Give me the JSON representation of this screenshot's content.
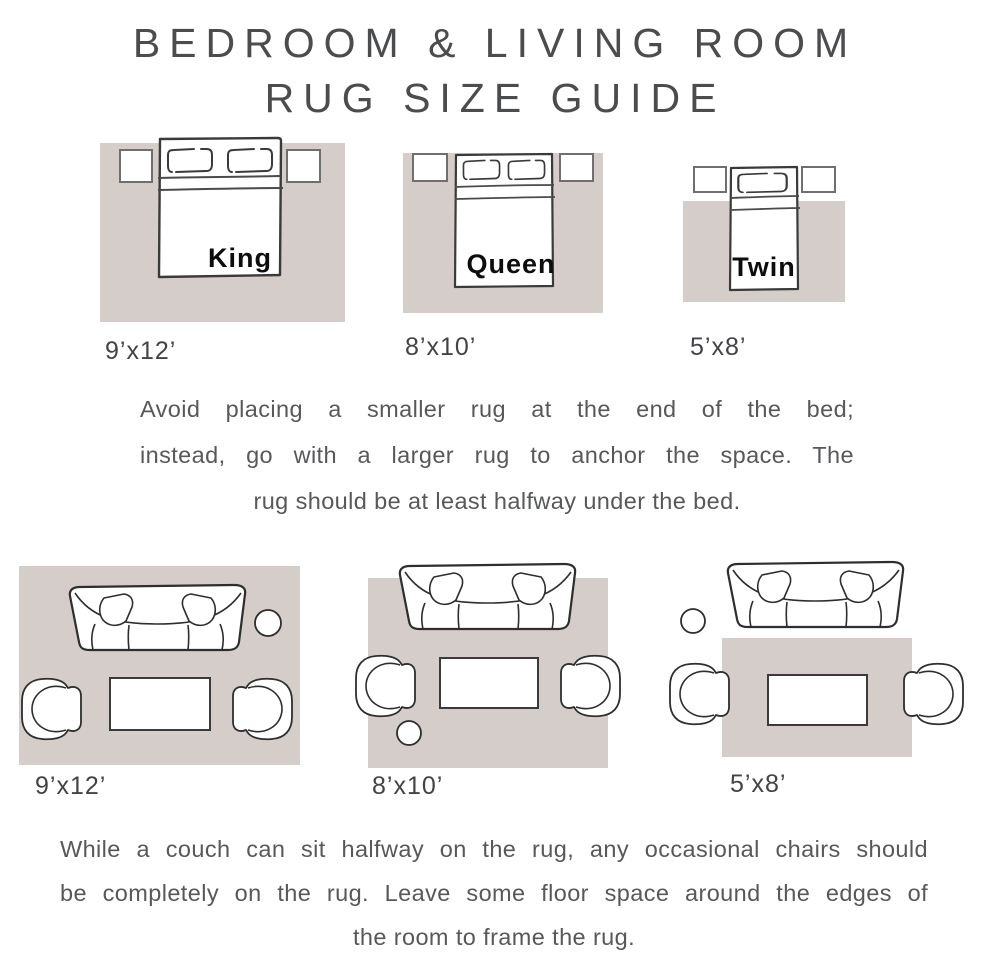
{
  "title": {
    "line1": "BEDROOM & LIVING ROOM",
    "line2": "RUG SIZE GUIDE"
  },
  "bedroom": {
    "diagrams": [
      {
        "bed": "King",
        "size": "9’x12’",
        "rug": "9 x 12 rug with king bed and two nightstands"
      },
      {
        "bed": "Queen",
        "size": "8’x10’",
        "rug": "8 x 10 rug with queen bed and two nightstands"
      },
      {
        "bed": "Twin",
        "size": "5’x8’",
        "rug": "5 x 8 rug with twin bed and two nightstands"
      }
    ],
    "note_lines": [
      "Avoid placing a smaller rug at the end of the bed;",
      "instead, go with a larger rug to anchor the space. The",
      "rug should be at least halfway under the bed."
    ]
  },
  "living_room": {
    "diagrams": [
      {
        "size": "9’x12’",
        "desc": "sofa, two chairs and coffee table fully on rug"
      },
      {
        "size": "8’x10’",
        "desc": "sofa halfway on rug, chairs fully on rug"
      },
      {
        "size": "5’x8’",
        "desc": "sofa off rug, chairs halfway on rug"
      }
    ],
    "note_lines": [
      "While a couch can sit halfway on the rug, any occasional chairs should",
      "be completely on the rug. Leave some floor space around the edges of",
      "the room to frame the rug."
    ]
  },
  "colors": {
    "rug": "#d5cdc9",
    "furniture_outline": "#2e2e2e",
    "nightstand_outline": "#6f6f6f",
    "body_text": "#57585a",
    "title_text": "#4b4c4e"
  }
}
